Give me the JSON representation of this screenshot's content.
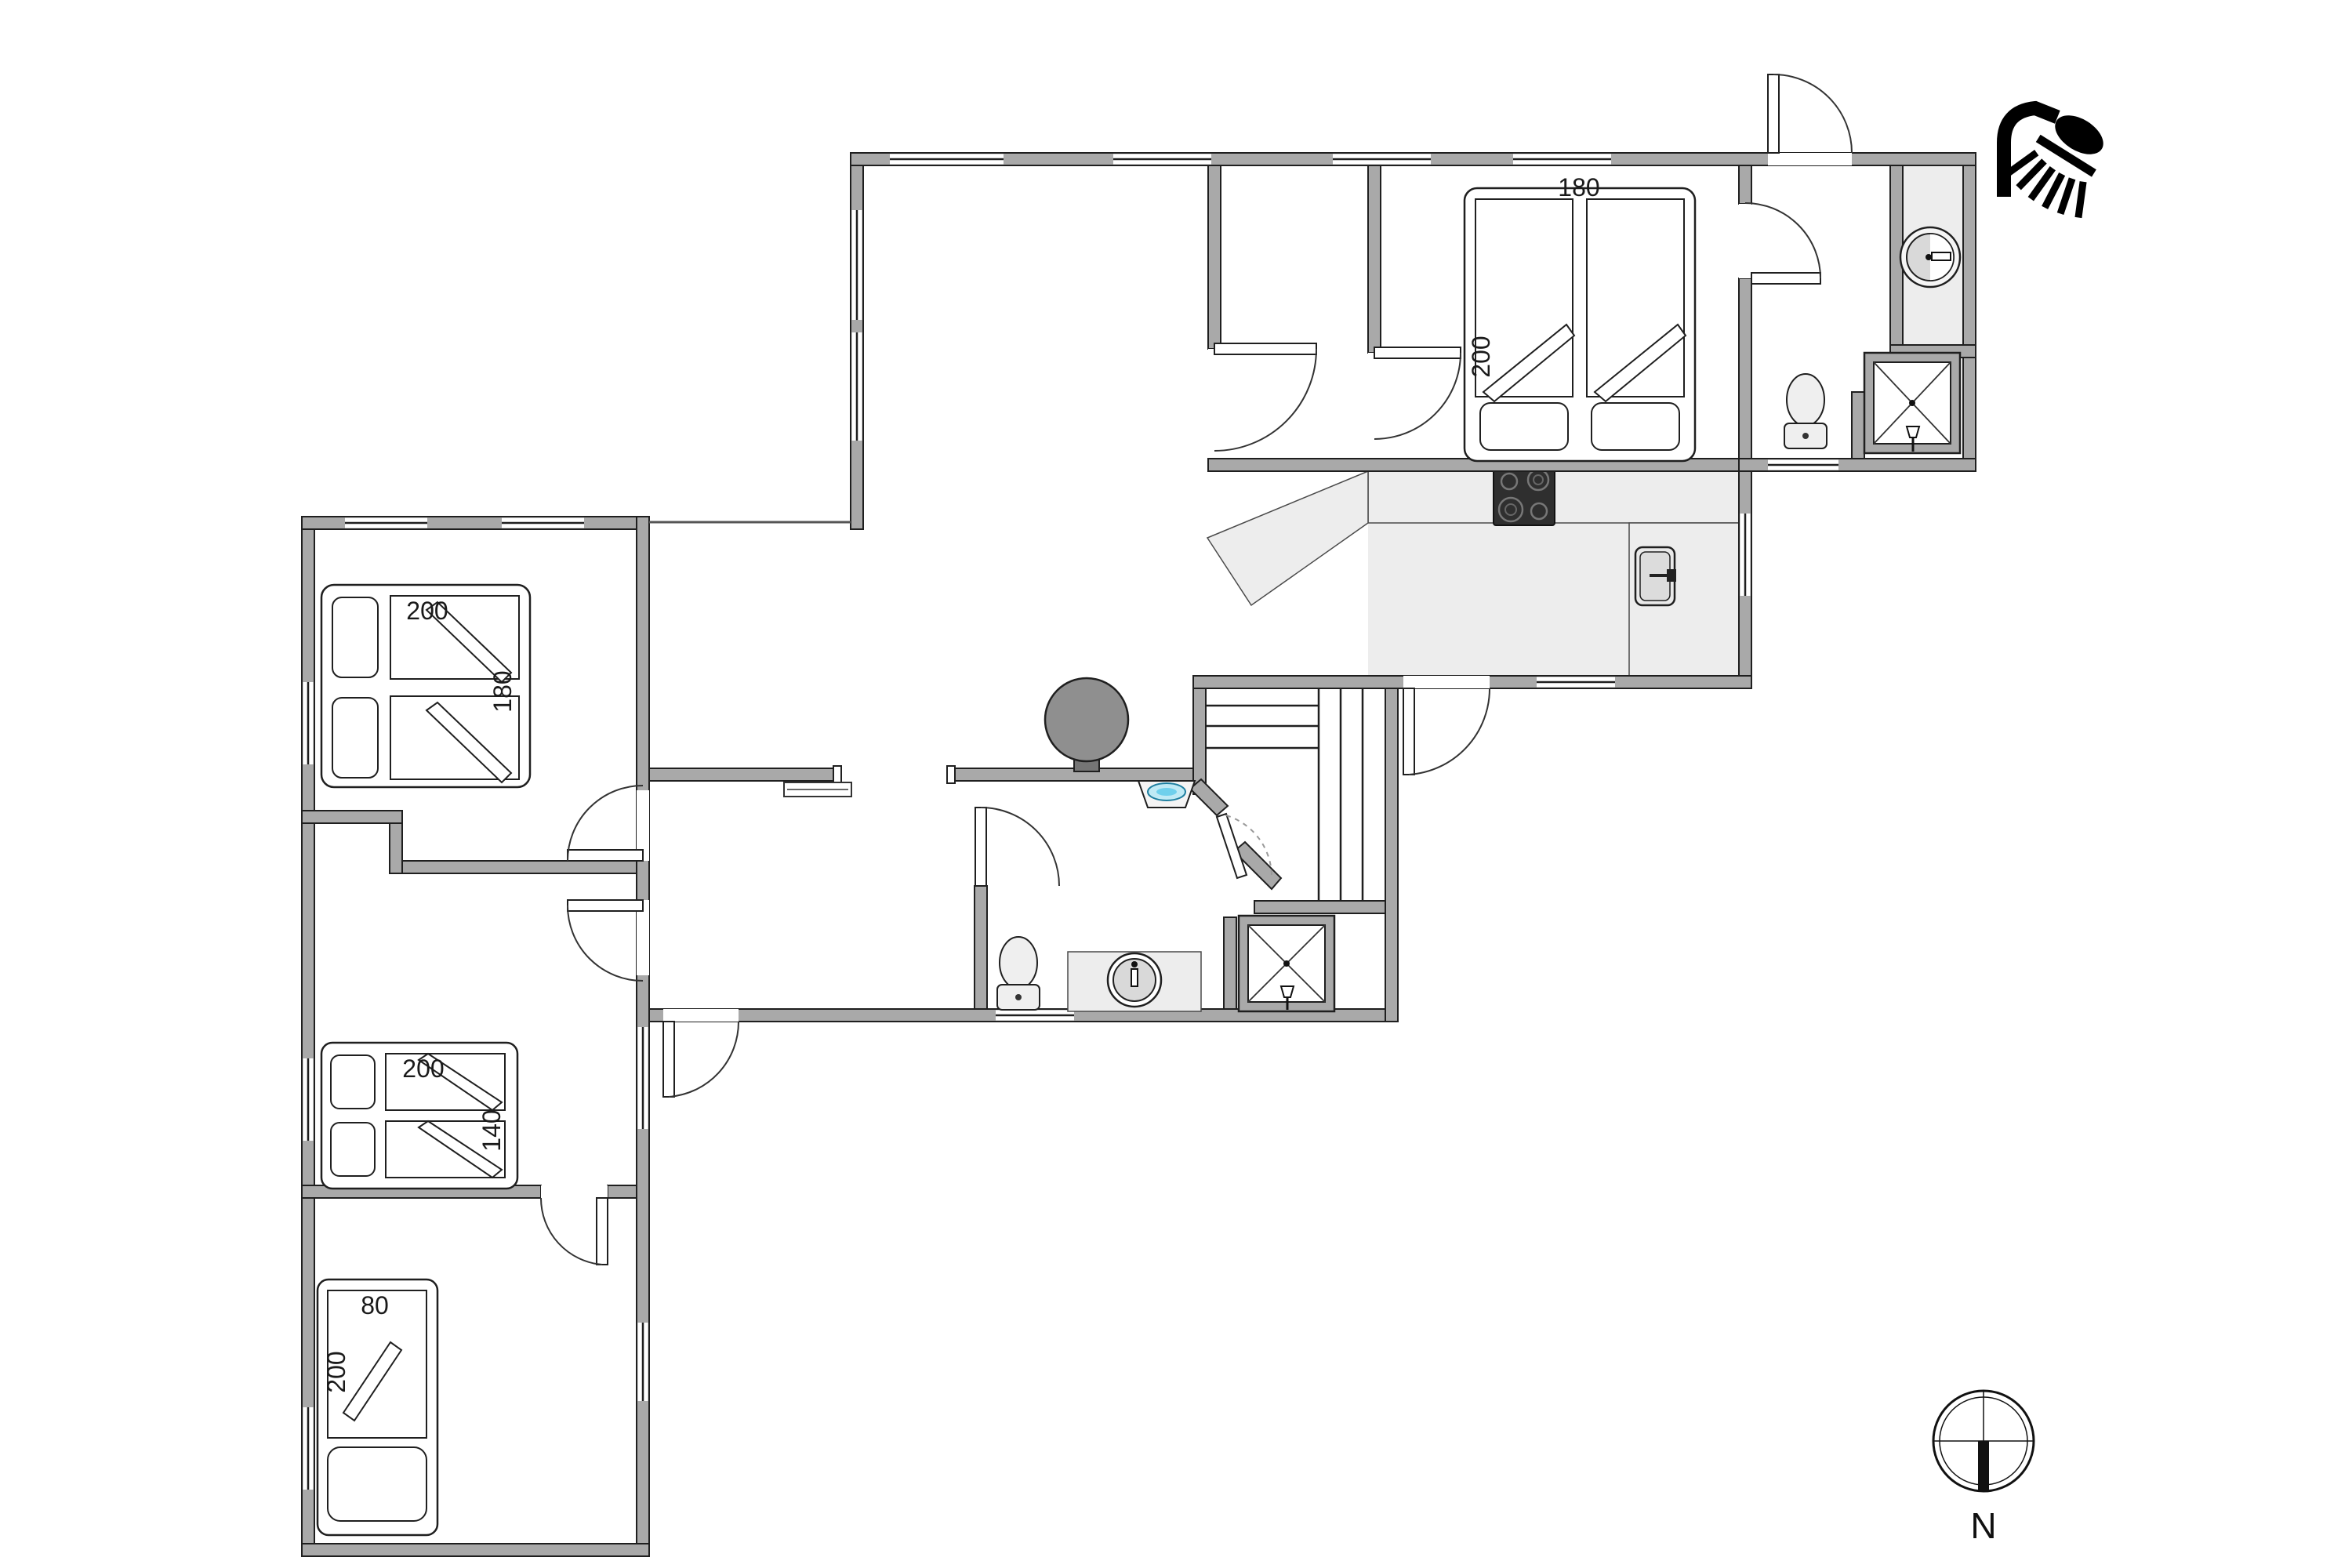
{
  "plan": {
    "type": "holiday-house floor plan",
    "beds": {
      "ne_double": {
        "width_label": "180",
        "length_label": "200"
      },
      "west_top_double": {
        "length_label": "200",
        "width_label": "180"
      },
      "west_middle_double": {
        "length_label": "200",
        "width_label": "140"
      },
      "west_bottom_single": {
        "width_label": "80",
        "length_label": "200"
      }
    },
    "compass": {
      "label": "N"
    },
    "fixtures": [
      "shower-head-icon",
      "compass-north-icon",
      "wood-stove",
      "stove-chimney",
      "cooktop-4-burners",
      "kitchen-sink",
      "kitchen-counter",
      "sauna-benches",
      "sauna-door",
      "bathroom-toilet",
      "bathroom-sink-counter",
      "bathroom-shower",
      "hall-corner-basin",
      "hall-wardrobe",
      "entry-toilet",
      "entry-shower",
      "entry-round-basin",
      "bed-pillows",
      "bed-duvets"
    ],
    "colors": {
      "wall": "#a9a9a9",
      "wall_outline": "#1f1f1f",
      "floor_light": "#ededed",
      "stove_gray": "#8f8f8f",
      "cooktop_black": "#2f2f2f",
      "basin_blue": "#bfeaf5",
      "fixture_fill": "#efefef",
      "icon_black": "#000000",
      "text": "#1a1a1a"
    }
  }
}
